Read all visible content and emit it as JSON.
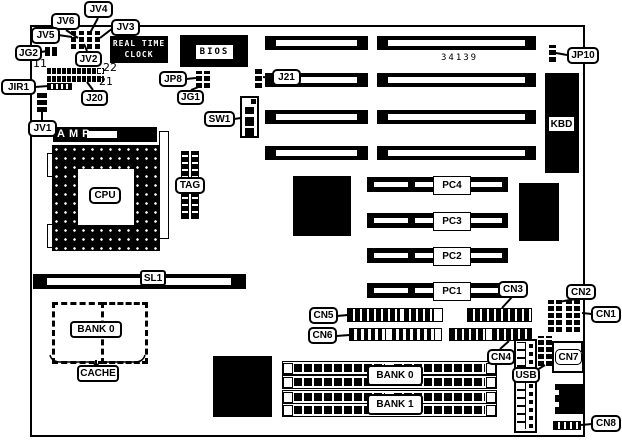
{
  "diagram": {
    "part_number": "34139"
  },
  "callouts": {
    "jv6": "JV6",
    "jv4": "JV4",
    "jv3": "JV3",
    "jv5": "JV5",
    "jg2": "JG2",
    "jv2": "JV2",
    "jir1": "JIR1",
    "j20": "J20",
    "jv1": "JV1",
    "jp8": "JP8",
    "jg1": "JG1",
    "sw1": "SW1",
    "j21": "J21",
    "jp10": "JP10",
    "cn5": "CN5",
    "cn6": "CN6",
    "cn3": "CN3",
    "cn4": "CN4",
    "cn2": "CN2",
    "cn1": "CN1",
    "cn7": "CN7",
    "cn8": "CN8",
    "usb": "USB",
    "cache": "CACHE"
  },
  "components": {
    "rtc_label": "REAL TIME CLOCK",
    "bios_label": "BIOS",
    "amp_label": "AMP",
    "cpu_label": "CPU",
    "tag_label": "TAG",
    "kbd_label": "KBD",
    "sl1_label": "SL1",
    "cache_bank_label": "BANK 0",
    "pci_slots": [
      "PC4",
      "PC3",
      "PC2",
      "PC1"
    ],
    "simm_banks": [
      "BANK 0",
      "BANK 1"
    ]
  },
  "pin_numbers": {
    "j20_pin11": "11",
    "j20_pin22": "22",
    "j20_pin21": "21"
  },
  "colors": {
    "ink": "#000000",
    "board_bg": "#ffffff"
  }
}
